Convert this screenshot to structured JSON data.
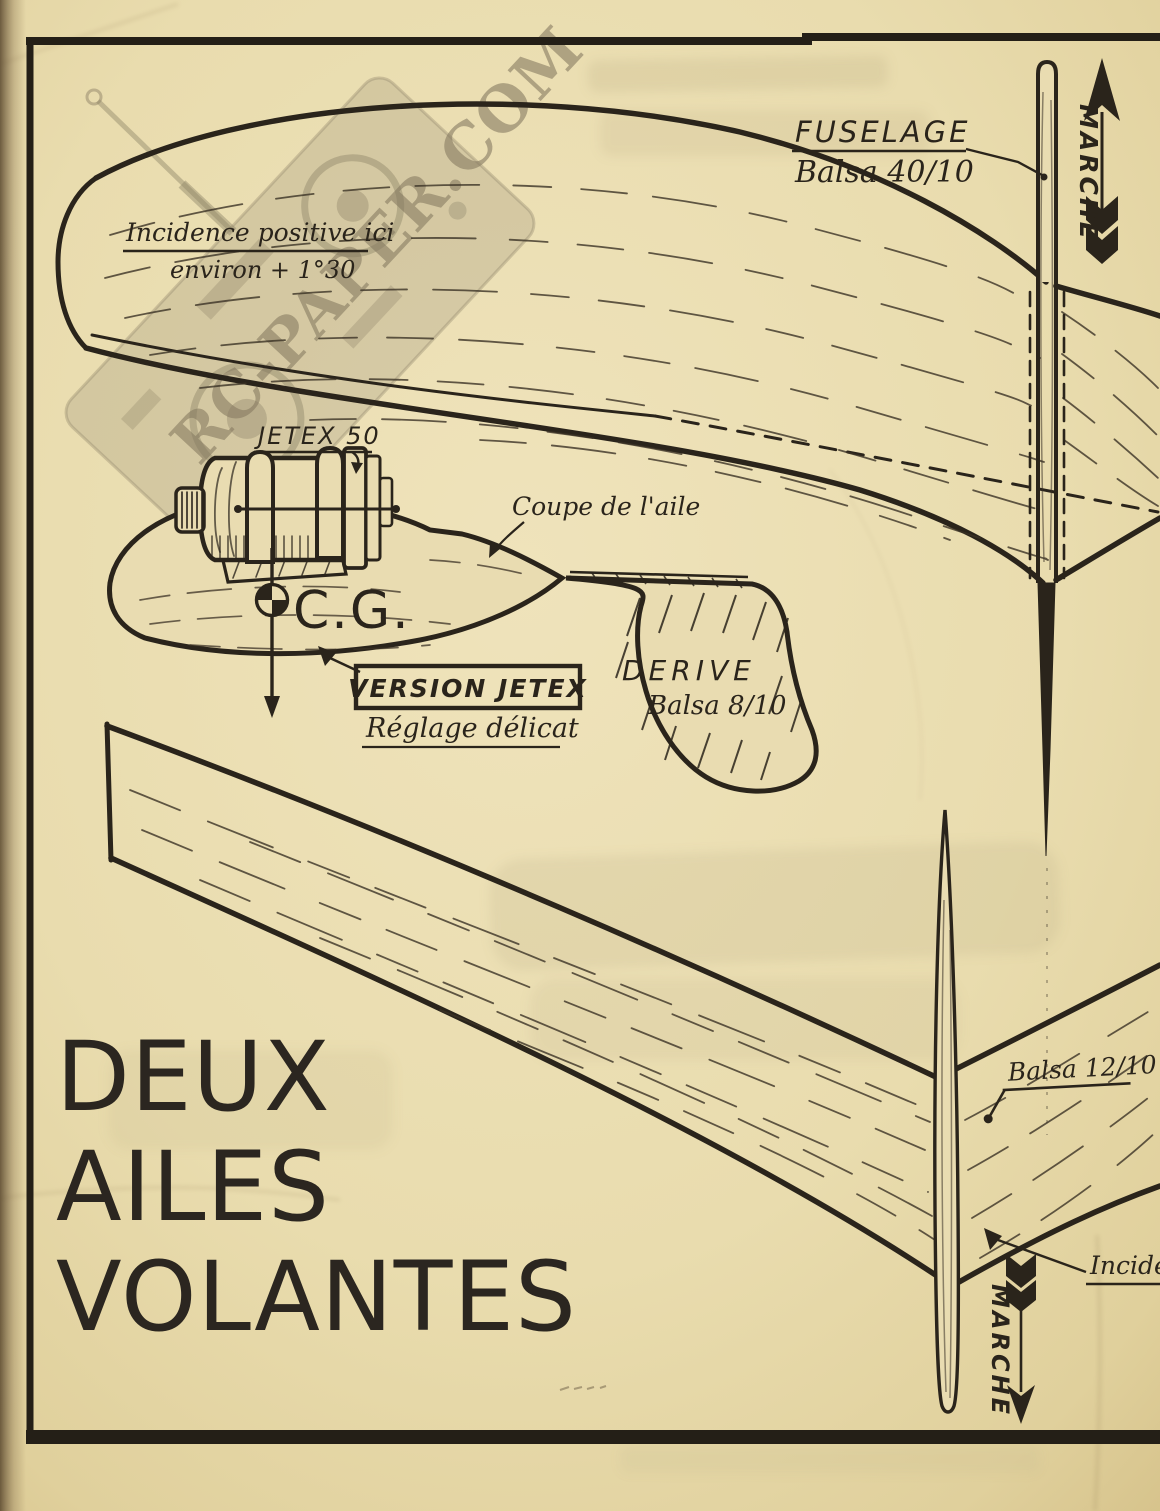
{
  "page": {
    "paper_color": "#e9dcb1",
    "ink_color": "#2a241b"
  },
  "watermark": {
    "text": "RC-PAPER.COM"
  },
  "title": {
    "lines": [
      "DEUX",
      "AILES",
      "VOLANTES"
    ]
  },
  "top_assembly": {
    "fuselage_label": "FUSELAGE",
    "fuselage_material": "Balsa 40/10",
    "direction_label": "MARCHE",
    "incidence_note_line1": "Incidence positive ici",
    "incidence_note_line2": "environ + 1°30"
  },
  "detail_view": {
    "engine_label": "JETEX 50",
    "wing_section_label": "Coupe de l'aile",
    "cg_label": "C.G.",
    "version_label": "VERSION JETEX",
    "tuning_note": "Réglage délicat",
    "fin_label": "DERIVE",
    "fin_material": "Balsa 8/10"
  },
  "bottom_assembly": {
    "material_label": "Balsa 12/10",
    "incidence_label": "Incidence",
    "direction_label": "MARCHE"
  }
}
